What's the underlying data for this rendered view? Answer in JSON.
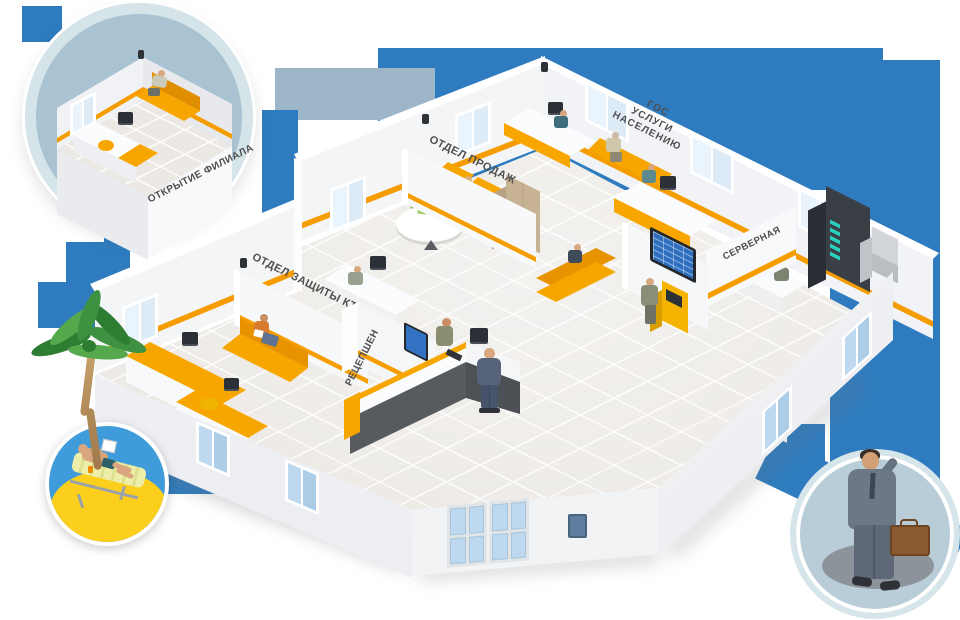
{
  "colors": {
    "accent_orange": "#F59D00",
    "brand_blue": "#2E7CBF",
    "muted_panel_blue": "#9CB6C8",
    "circle_ring": "#D6E5EA",
    "sky_blue": "#3F9BD9",
    "sand_yellow": "#FBCF1C",
    "wall_white": "#F4F5F7",
    "floor_beige": "#ECE9E5"
  },
  "callouts": {
    "branch_opening": {
      "label": "ОТКРЫТИЕ ФИЛИАЛА"
    }
  },
  "rooms": {
    "sales": {
      "label": "ОТДЕЛ ПРОДАЖ"
    },
    "gov_services": {
      "label_lines": [
        "ГОС",
        "УСЛУГИ",
        "НАСЕЛЕНИЮ"
      ]
    },
    "server_room": {
      "label": "СЕРВЕРНАЯ"
    },
    "it_security": {
      "label": "ОТДЕЛ ЗАЩИТЫ КТ"
    },
    "reception": {
      "label": "РЕЦЕПШЕН"
    }
  }
}
